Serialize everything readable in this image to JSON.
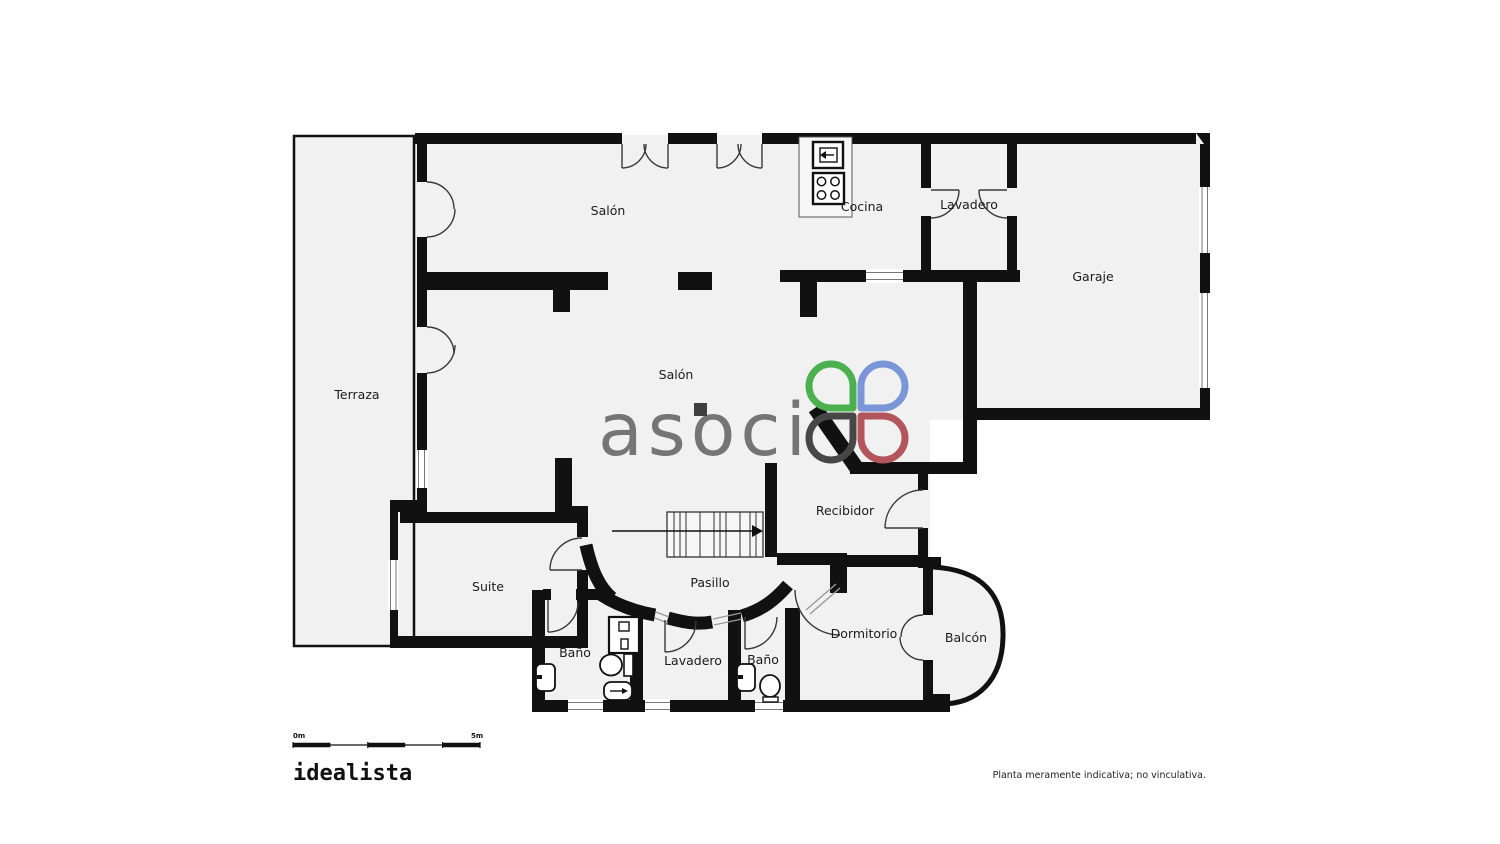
{
  "plan": {
    "rooms": [
      {
        "id": "terraza",
        "name": "Terraza"
      },
      {
        "id": "salon-top",
        "name": "Salón"
      },
      {
        "id": "cocina",
        "name": "Cocina"
      },
      {
        "id": "lavadero-top",
        "name": "Lavadero"
      },
      {
        "id": "garaje",
        "name": "Garaje"
      },
      {
        "id": "salon-main",
        "name": "Salón"
      },
      {
        "id": "recibidor",
        "name": "Recibidor"
      },
      {
        "id": "pasillo",
        "name": "Pasillo"
      },
      {
        "id": "suite",
        "name": "Suite"
      },
      {
        "id": "bano-suite",
        "name": "Baño"
      },
      {
        "id": "lavadero-bottom",
        "name": "Lavadero"
      },
      {
        "id": "bano-small",
        "name": "Baño"
      },
      {
        "id": "dormitorio",
        "name": "Dormitorio"
      },
      {
        "id": "balcon",
        "name": "Balcón"
      }
    ],
    "fixtures": [
      "oven-icon",
      "hob-icon",
      "counter-outline",
      "washbasin-icon",
      "toilet-icon",
      "bidet-icon",
      "wall-sink-icon",
      "stairs",
      "stairs-direction-arrow"
    ],
    "colors": {
      "walls": "#111111",
      "floor": "#f1f1f1",
      "door_lines": "#3a3a3a"
    }
  },
  "watermark": {
    "text": "asoci",
    "colors": {
      "text_gray": "#6b6b6b",
      "petal_green": "#4db04e",
      "petal_blue": "#7b96d8",
      "petal_dark": "#474747",
      "petal_red": "#b3555c"
    }
  },
  "scalebar": {
    "label_start": "0m",
    "label_end": "5m"
  },
  "footer": {
    "brand": "idealista",
    "disclaimer": "Planta meramente indicativa; no vinculativa."
  }
}
